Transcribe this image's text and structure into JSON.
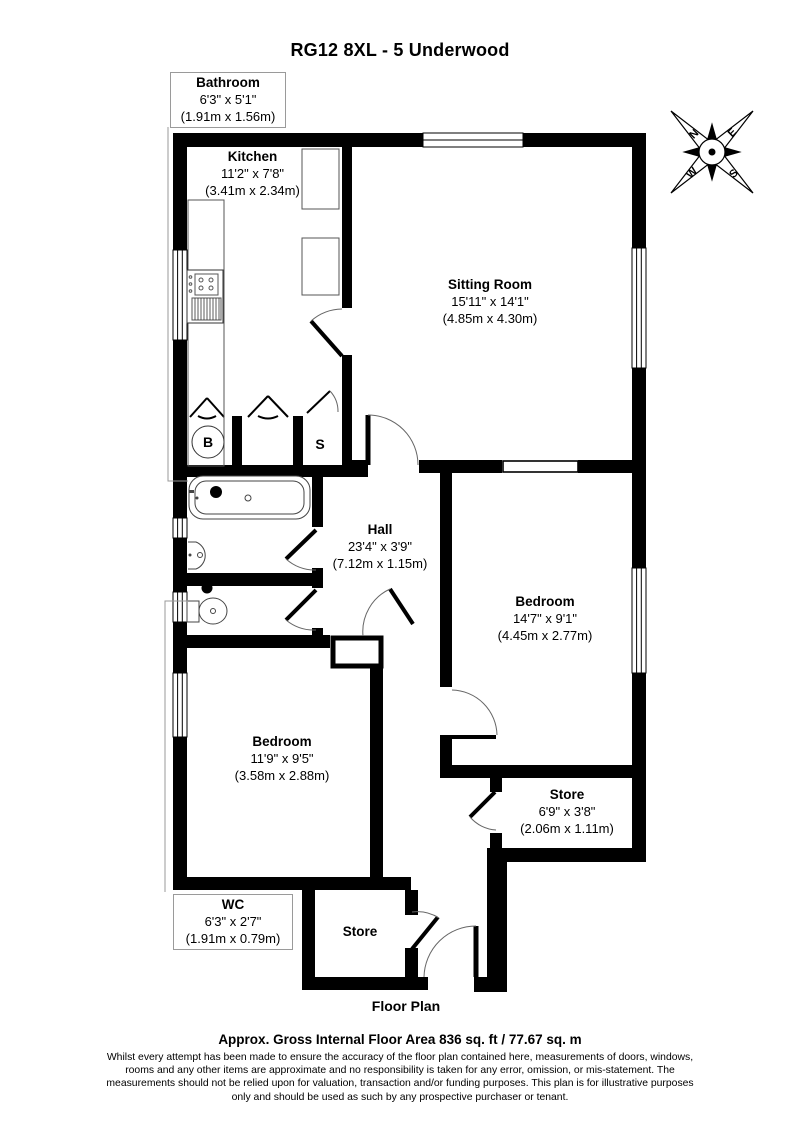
{
  "title": "RG12 8XL - 5 Underwood",
  "plan_label": "Floor Plan",
  "rooms": [
    {
      "id": "bathroom",
      "name": "Bathroom",
      "imperial": "6'3\" x 5'1\"",
      "metric": "(1.91m x 1.56m)"
    },
    {
      "id": "kitchen",
      "name": "Kitchen",
      "imperial": "11'2\" x 7'8\"",
      "metric": "(3.41m x 2.34m)"
    },
    {
      "id": "sitting-room",
      "name": "Sitting Room",
      "imperial": "15'11\" x 14'1\"",
      "metric": "(4.85m x 4.30m)"
    },
    {
      "id": "hall",
      "name": "Hall",
      "imperial": "23'4\" x 3'9\"",
      "metric": "(7.12m x 1.15m)"
    },
    {
      "id": "bedroom-right",
      "name": "Bedroom",
      "imperial": "14'7\" x 9'1\"",
      "metric": "(4.45m x 2.77m)"
    },
    {
      "id": "bedroom-left",
      "name": "Bedroom",
      "imperial": "11'9\" x 9'5\"",
      "metric": "(3.58m x 2.88m)"
    },
    {
      "id": "store-right",
      "name": "Store",
      "imperial": "6'9\" x 3'8\"",
      "metric": "(2.06m x 1.11m)"
    },
    {
      "id": "wc",
      "name": "WC",
      "imperial": "6'3\" x 2'7\"",
      "metric": "(1.91m x 0.79m)"
    },
    {
      "id": "store-bottom",
      "name": "Store",
      "imperial": "",
      "metric": ""
    }
  ],
  "markers": {
    "boiler": "B",
    "storage": "S"
  },
  "compass": {
    "n": "N",
    "e": "E",
    "s": "S",
    "w": "W"
  },
  "footer": {
    "area": "Approx. Gross Internal Floor Area 836 sq. ft / 77.67 sq. m",
    "disclaimer_lines": [
      "Whilst every attempt has been made to ensure the accuracy of the floor plan contained here, measurements of doors, windows,",
      "rooms and any other items are approximate and no responsibility is taken for any error, omission, or mis-statement. The",
      "measurements should not be relied upon for valuation, transaction and/or funding purposes. This plan is for illustrative purposes",
      "only and should be used as such by any prospective purchaser or tenant."
    ]
  },
  "colors": {
    "wall": "#000000",
    "background": "#ffffff",
    "fixture_outline": "#444444",
    "label_box_border": "#9a9a9a"
  }
}
